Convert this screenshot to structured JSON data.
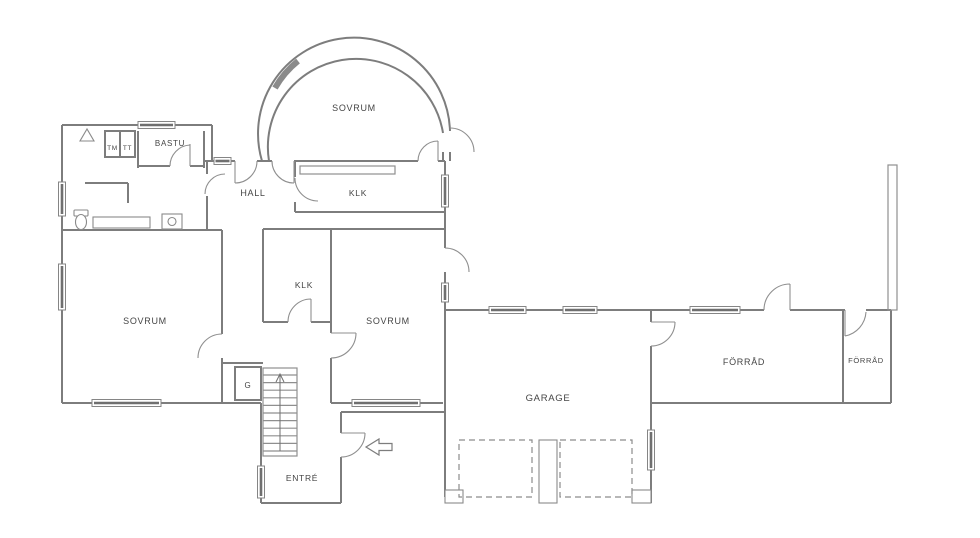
{
  "floorplan": {
    "type": "architectural-floor-plan",
    "rooms": [
      {
        "id": "sovrum-arch",
        "label": "SOVRUM"
      },
      {
        "id": "bastu",
        "label": "BASTU"
      },
      {
        "id": "tm",
        "label": "TM"
      },
      {
        "id": "tt",
        "label": "TT"
      },
      {
        "id": "hall",
        "label": "HALL"
      },
      {
        "id": "klk-upper",
        "label": "KLK"
      },
      {
        "id": "klk-inner",
        "label": "KLK"
      },
      {
        "id": "sovrum-left",
        "label": "SOVRUM"
      },
      {
        "id": "sovrum-middle",
        "label": "SOVRUM"
      },
      {
        "id": "garderob",
        "label": "G"
      },
      {
        "id": "entre",
        "label": "ENTRÉ"
      },
      {
        "id": "garage",
        "label": "GARAGE"
      },
      {
        "id": "forrad-large",
        "label": "FÖRRÅD"
      },
      {
        "id": "forrad-small",
        "label": "FÖRRÅD"
      }
    ],
    "symbols": {
      "entrance_arrow_direction": "left",
      "stair_direction": "up"
    },
    "colors": {
      "background": "#ffffff",
      "wall": "#7d7d7d",
      "label": "#454545",
      "window": "#6f6f6f"
    }
  }
}
